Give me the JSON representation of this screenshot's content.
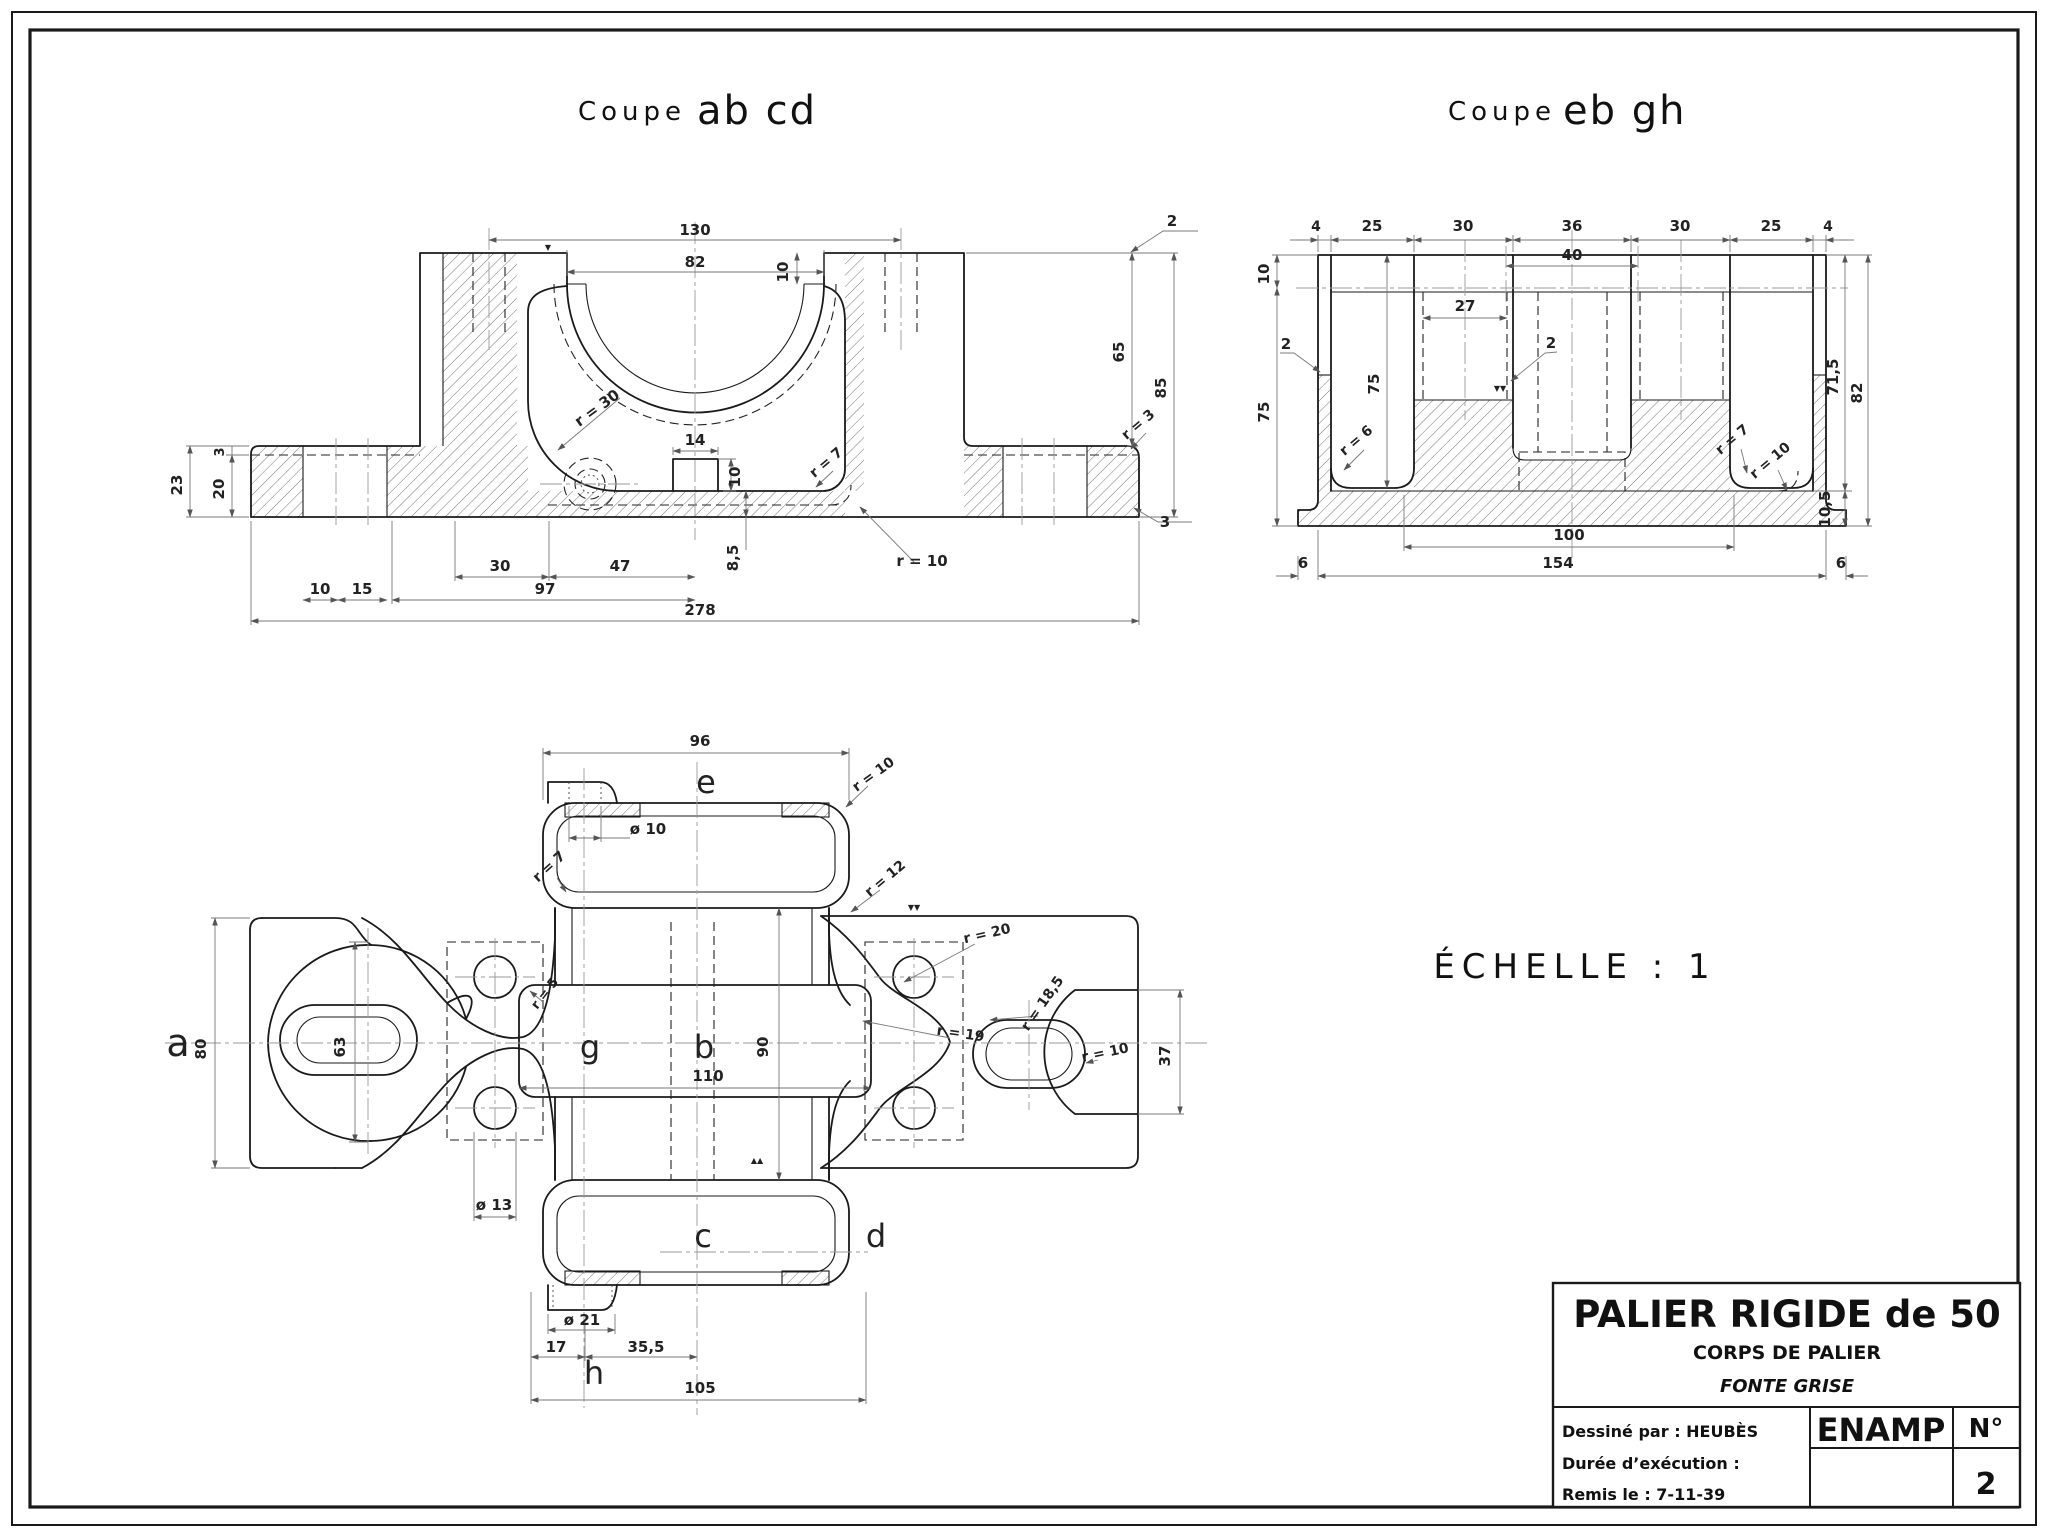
{
  "titles": {
    "left_prefix": "Coupe",
    "left_name": "ab cd",
    "right_prefix": "Coupe",
    "right_name": "eb gh"
  },
  "scale_note": "ÉCHELLE : 1",
  "title_block": {
    "title": "PALIER RIGIDE de 50",
    "subtitle": "CORPS DE PALIER",
    "material": "FONTE GRISE",
    "drawn_by": "Dessiné par : HEUBÈS",
    "duration": "Durée d’exécution :",
    "submitted": "Remis le : 7-11-39",
    "school": "ENAMP",
    "number_label": "N°",
    "sheet_number": "2"
  },
  "annotations": [
    {
      "t": "130",
      "x": 695,
      "y": 235,
      "r": 0,
      "s": 15,
      "c": "dim"
    },
    {
      "t": "82",
      "x": 695,
      "y": 267,
      "r": 0,
      "s": 15,
      "c": "dim"
    },
    {
      "t": "10",
      "x": 788,
      "y": 272,
      "r": -90,
      "s": 15,
      "c": "dim"
    },
    {
      "t": "14",
      "x": 695,
      "y": 445,
      "r": 0,
      "s": 15,
      "c": "dim"
    },
    {
      "t": "10",
      "x": 740,
      "y": 477,
      "r": -90,
      "s": 15,
      "c": "dim"
    },
    {
      "t": "8,5",
      "x": 738,
      "y": 558,
      "r": -90,
      "s": 15,
      "c": "dim"
    },
    {
      "t": "r = 30",
      "x": 600,
      "y": 412,
      "r": -36,
      "s": 15,
      "c": "dim"
    },
    {
      "t": "r = 7",
      "x": 829,
      "y": 466,
      "r": -40,
      "s": 14,
      "c": "dim"
    },
    {
      "t": "r = 3",
      "x": 1141,
      "y": 428,
      "r": -40,
      "s": 14,
      "c": "dim"
    },
    {
      "t": "2",
      "x": 1172,
      "y": 226,
      "r": 0,
      "s": 15,
      "c": "dim"
    },
    {
      "t": "3",
      "x": 1165,
      "y": 527,
      "r": 0,
      "s": 15,
      "c": "dim"
    },
    {
      "t": "65",
      "x": 1124,
      "y": 352,
      "r": -90,
      "s": 15,
      "c": "dim"
    },
    {
      "t": "85",
      "x": 1166,
      "y": 388,
      "r": -90,
      "s": 15,
      "c": "dim"
    },
    {
      "t": "23",
      "x": 182,
      "y": 485,
      "r": -90,
      "s": 15,
      "c": "dim"
    },
    {
      "t": "20",
      "x": 224,
      "y": 489,
      "r": -90,
      "s": 15,
      "c": "dim"
    },
    {
      "t": "3",
      "x": 224,
      "y": 452,
      "r": -90,
      "s": 13,
      "c": "dim"
    },
    {
      "t": "30",
      "x": 500,
      "y": 571,
      "r": 0,
      "s": 15,
      "c": "dim"
    },
    {
      "t": "47",
      "x": 620,
      "y": 571,
      "r": 0,
      "s": 15,
      "c": "dim"
    },
    {
      "t": "10",
      "x": 320,
      "y": 594,
      "r": 0,
      "s": 15,
      "c": "dim"
    },
    {
      "t": "15",
      "x": 362,
      "y": 594,
      "r": 0,
      "s": 15,
      "c": "dim"
    },
    {
      "t": "97",
      "x": 545,
      "y": 594,
      "r": 0,
      "s": 15,
      "c": "dim"
    },
    {
      "t": "278",
      "x": 700,
      "y": 615,
      "r": 0,
      "s": 15,
      "c": "dim"
    },
    {
      "t": "r = 10",
      "x": 922,
      "y": 566,
      "r": 0,
      "s": 15,
      "c": "dim"
    },
    {
      "t": "4",
      "x": 1316,
      "y": 231,
      "r": 0,
      "s": 14,
      "c": "dim"
    },
    {
      "t": "25",
      "x": 1372,
      "y": 231,
      "r": 0,
      "s": 15,
      "c": "dim"
    },
    {
      "t": "30",
      "x": 1463,
      "y": 231,
      "r": 0,
      "s": 15,
      "c": "dim"
    },
    {
      "t": "36",
      "x": 1572,
      "y": 231,
      "r": 0,
      "s": 15,
      "c": "dim"
    },
    {
      "t": "30",
      "x": 1680,
      "y": 231,
      "r": 0,
      "s": 15,
      "c": "dim"
    },
    {
      "t": "25",
      "x": 1771,
      "y": 231,
      "r": 0,
      "s": 15,
      "c": "dim"
    },
    {
      "t": "4",
      "x": 1828,
      "y": 231,
      "r": 0,
      "s": 14,
      "c": "dim"
    },
    {
      "t": "40",
      "x": 1572,
      "y": 260,
      "r": 0,
      "s": 15,
      "c": "dim"
    },
    {
      "t": "27",
      "x": 1465,
      "y": 311,
      "r": 0,
      "s": 15,
      "c": "dim"
    },
    {
      "t": "2",
      "x": 1286,
      "y": 349,
      "r": 0,
      "s": 15,
      "c": "dim"
    },
    {
      "t": "2",
      "x": 1551,
      "y": 348,
      "r": 0,
      "s": 15,
      "c": "dim"
    },
    {
      "t": "10",
      "x": 1269,
      "y": 274,
      "r": -90,
      "s": 15,
      "c": "dim"
    },
    {
      "t": "75",
      "x": 1269,
      "y": 412,
      "r": -90,
      "s": 15,
      "c": "dim"
    },
    {
      "t": "75",
      "x": 1379,
      "y": 384,
      "r": -90,
      "s": 15,
      "c": "dim"
    },
    {
      "t": "r = 6",
      "x": 1359,
      "y": 444,
      "r": -40,
      "s": 14,
      "c": "dim"
    },
    {
      "t": "r = 7",
      "x": 1735,
      "y": 443,
      "r": -40,
      "s": 14,
      "c": "dim"
    },
    {
      "t": "r = 10",
      "x": 1773,
      "y": 464,
      "r": -40,
      "s": 14,
      "c": "dim"
    },
    {
      "t": "71,5",
      "x": 1838,
      "y": 377,
      "r": -90,
      "s": 15,
      "c": "dim"
    },
    {
      "t": "82",
      "x": 1862,
      "y": 393,
      "r": -90,
      "s": 15,
      "c": "dim"
    },
    {
      "t": "10,5",
      "x": 1830,
      "y": 509,
      "r": -90,
      "s": 15,
      "c": "dim"
    },
    {
      "t": "100",
      "x": 1569,
      "y": 540,
      "r": 0,
      "s": 15,
      "c": "dim"
    },
    {
      "t": "154",
      "x": 1558,
      "y": 568,
      "r": 0,
      "s": 15,
      "c": "dim"
    },
    {
      "t": "6",
      "x": 1303,
      "y": 568,
      "r": 0,
      "s": 15,
      "c": "dim"
    },
    {
      "t": "6",
      "x": 1841,
      "y": 568,
      "r": 0,
      "s": 15,
      "c": "dim"
    },
    {
      "t": "96",
      "x": 700,
      "y": 746,
      "r": 0,
      "s": 15,
      "c": "dim"
    },
    {
      "t": "ø 10",
      "x": 648,
      "y": 834,
      "r": 0,
      "s": 15,
      "c": "dim"
    },
    {
      "t": "r = 7",
      "x": 552,
      "y": 870,
      "r": -42,
      "s": 14,
      "c": "dim"
    },
    {
      "t": "r = 10",
      "x": 876,
      "y": 778,
      "r": -36,
      "s": 14,
      "c": "dim"
    },
    {
      "t": "r = 12",
      "x": 888,
      "y": 882,
      "r": -40,
      "s": 14,
      "c": "dim"
    },
    {
      "t": "r = 5",
      "x": 548,
      "y": 996,
      "r": -52,
      "s": 13,
      "c": "dim"
    },
    {
      "t": "80",
      "x": 206,
      "y": 1049,
      "r": -90,
      "s": 15,
      "c": "dim"
    },
    {
      "t": "63",
      "x": 345,
      "y": 1047,
      "r": -90,
      "s": 15,
      "c": "dim"
    },
    {
      "t": "90",
      "x": 768,
      "y": 1047,
      "r": -90,
      "s": 15,
      "c": "dim"
    },
    {
      "t": "110",
      "x": 708,
      "y": 1081,
      "r": 0,
      "s": 15,
      "c": "dim"
    },
    {
      "t": "r = 20",
      "x": 988,
      "y": 938,
      "r": -13,
      "s": 14,
      "c": "dim"
    },
    {
      "t": "r = 19",
      "x": 960,
      "y": 1038,
      "r": 8,
      "s": 14,
      "c": "dim"
    },
    {
      "t": "r = 18,5",
      "x": 1046,
      "y": 1006,
      "r": -55,
      "s": 14,
      "c": "dim"
    },
    {
      "t": "r = 10",
      "x": 1106,
      "y": 1057,
      "r": -12,
      "s": 14,
      "c": "dim"
    },
    {
      "t": "37",
      "x": 1170,
      "y": 1056,
      "r": -90,
      "s": 15,
      "c": "dim"
    },
    {
      "t": "ø 13",
      "x": 494,
      "y": 1210,
      "r": 0,
      "s": 15,
      "c": "dim"
    },
    {
      "t": "ø 21",
      "x": 582,
      "y": 1325,
      "r": 0,
      "s": 15,
      "c": "dim"
    },
    {
      "t": "17",
      "x": 556,
      "y": 1352,
      "r": 0,
      "s": 15,
      "c": "dim"
    },
    {
      "t": "35,5",
      "x": 646,
      "y": 1352,
      "r": 0,
      "s": 15,
      "c": "dim"
    },
    {
      "t": "105",
      "x": 700,
      "y": 1393,
      "r": 0,
      "s": 15,
      "c": "dim"
    },
    {
      "t": "a",
      "x": 178,
      "y": 1056,
      "r": 0,
      "s": 38,
      "c": "letter"
    },
    {
      "t": "e",
      "x": 706,
      "y": 793,
      "r": 0,
      "s": 32,
      "c": "letter"
    },
    {
      "t": "g",
      "x": 590,
      "y": 1058,
      "r": 0,
      "s": 32,
      "c": "letter"
    },
    {
      "t": "b",
      "x": 704,
      "y": 1058,
      "r": 0,
      "s": 32,
      "c": "letter"
    },
    {
      "t": "c",
      "x": 703,
      "y": 1247,
      "r": 0,
      "s": 32,
      "c": "letter"
    },
    {
      "t": "d",
      "x": 876,
      "y": 1247,
      "r": 0,
      "s": 32,
      "c": "letter"
    },
    {
      "t": "h",
      "x": 594,
      "y": 1384,
      "r": 0,
      "s": 32,
      "c": "letter"
    },
    {
      "t": "▼▼",
      "x": 914,
      "y": 910,
      "r": 0,
      "s": 8,
      "c": "mark"
    },
    {
      "t": "▼▼",
      "x": 1500,
      "y": 391,
      "r": 0,
      "s": 8,
      "c": "mark"
    },
    {
      "t": "▲▲",
      "x": 757,
      "y": 1163,
      "r": 0,
      "s": 8,
      "c": "mark"
    },
    {
      "t": "▼",
      "x": 548,
      "y": 250,
      "r": 0,
      "s": 8,
      "c": "mark"
    }
  ]
}
